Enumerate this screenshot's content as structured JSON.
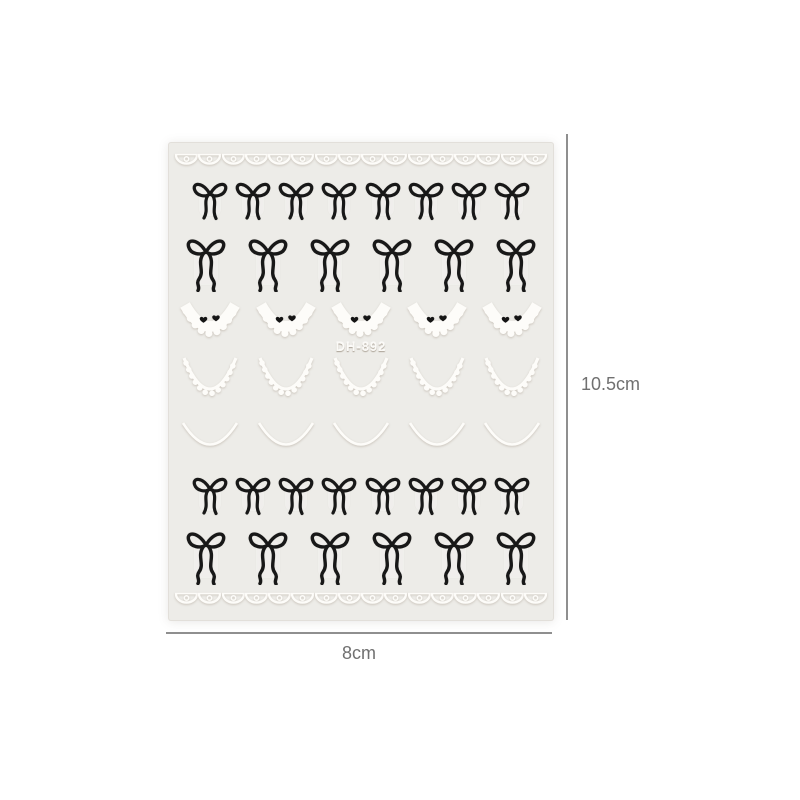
{
  "page": {
    "background_color": "#ffffff"
  },
  "product": {
    "description": "nail art sticker sheet with black ribbon bows and white lace french-tip decals",
    "sheet_code": "DH-892",
    "sheet_color": "#edece8",
    "bow_color": "#181818",
    "lace_color": "#fdfcf9",
    "rows": [
      {
        "type": "lace-border",
        "count": 16
      },
      {
        "type": "bow-small",
        "count": 8
      },
      {
        "type": "bow-long",
        "count": 6
      },
      {
        "type": "lace-collar",
        "count": 5
      },
      {
        "type": "lace-arc",
        "count": 5
      },
      {
        "type": "thin-curve",
        "count": 5
      },
      {
        "type": "bow-small",
        "count": 8
      },
      {
        "type": "bow-long",
        "count": 6
      },
      {
        "type": "lace-border",
        "count": 16
      }
    ]
  },
  "dimensions": {
    "height_label": "10.5cm",
    "width_label": "8cm",
    "line_color": "#8f8f8f",
    "label_color": "#707070"
  }
}
